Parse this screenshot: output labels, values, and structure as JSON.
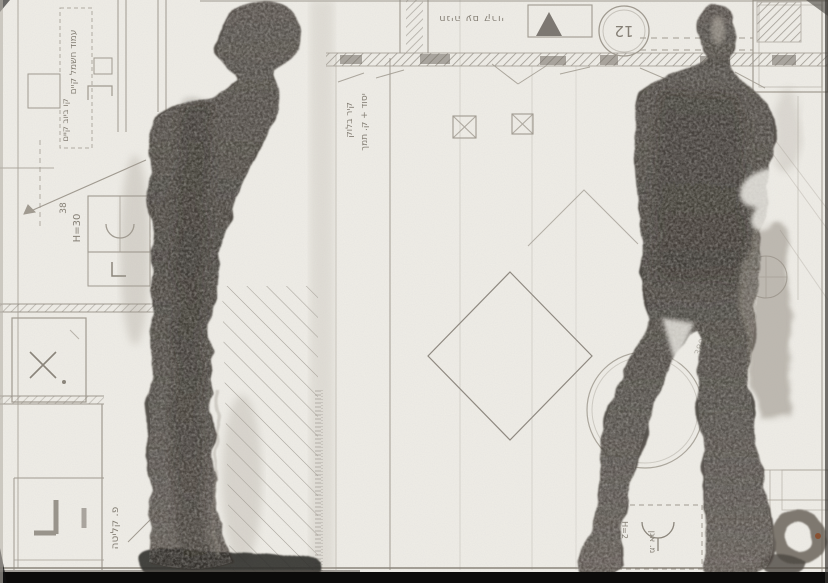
{
  "artwork": {
    "description": "Scanned mixed-media artwork: two dark ink-wash standing figures painted over a photocopied architectural floor plan",
    "left_figure": "standing figure in profile, full height, dark ink silhouette",
    "right_figure": "standing frontal figure with lighter echo shadow, dark ink silhouette"
  },
  "palette": {
    "paper": "#f0eee8",
    "plan_line": "#a19b91",
    "plan_line_dark": "#857f75",
    "ink_dark": "#413c36",
    "ink_mid": "#6e675e",
    "ink_wash": "#9b948a",
    "scan_border": "#0c0b0a",
    "rust_speck": "#8a4a28"
  },
  "annotations": {
    "parking": "חניה עם קרוי",
    "circle_number": "12",
    "wall_line1": "קיר בלוק",
    "wall_line2": "יסוד + ק. תמך",
    "pole": "עמוד חשמל קיים",
    "sewer": "קו ביוב קיים",
    "dim_38": "38",
    "height_30": "H=30",
    "intake": "פ. קליטה",
    "height_580": "H=580",
    "height_2": "H=2",
    "basin": "מ. אגן",
    "dim_380": "380"
  }
}
